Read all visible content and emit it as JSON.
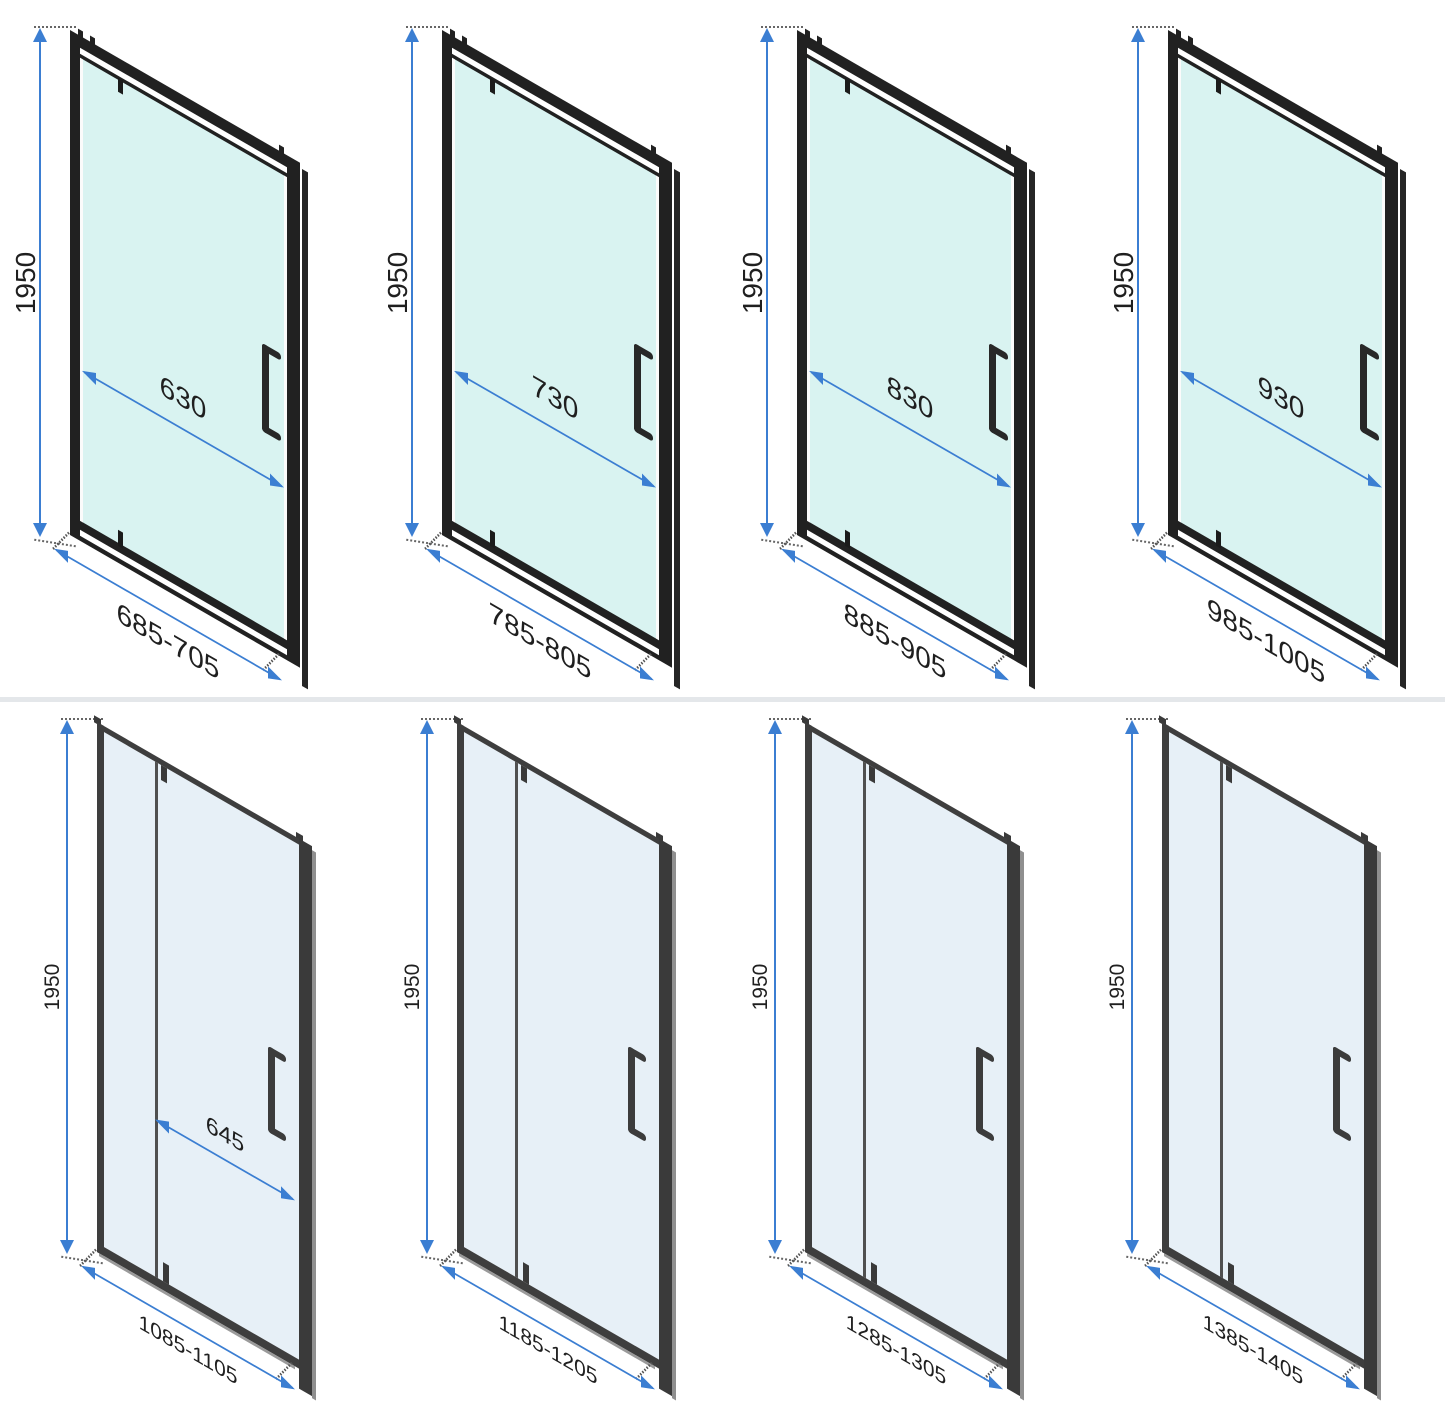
{
  "diagram": {
    "description": "Shower door technical dimension drawings, 8 size variants",
    "units": "mm",
    "rows": [
      {
        "name": "framed pivot doors",
        "doors": [
          {
            "height_label": "1950",
            "inner_width_label": "630",
            "width_range_label": "685-705"
          },
          {
            "height_label": "1950",
            "inner_width_label": "730",
            "width_range_label": "785-805"
          },
          {
            "height_label": "1950",
            "inner_width_label": "830",
            "width_range_label": "885-905"
          },
          {
            "height_label": "1950",
            "inner_width_label": "930",
            "width_range_label": "985-1005"
          }
        ]
      },
      {
        "name": "sliding doors",
        "doors": [
          {
            "height_label": "1950",
            "inner_width_label": "645",
            "width_range_label": "1085-1105"
          },
          {
            "height_label": "1950",
            "width_range_label": "1185-1205"
          },
          {
            "height_label": "1950",
            "width_range_label": "1285-1305"
          },
          {
            "height_label": "1950",
            "width_range_label": "1385-1405"
          }
        ]
      }
    ],
    "colors": {
      "dimension_blue": "#3b7ed2",
      "frame_black": "#212121",
      "frame_gray": "#3e3e3e",
      "glass_tinted": "#d9f3f1",
      "glass_pale": "#e7f0f7",
      "label_text": "#1f1f1f",
      "background": "#ffffff"
    }
  }
}
